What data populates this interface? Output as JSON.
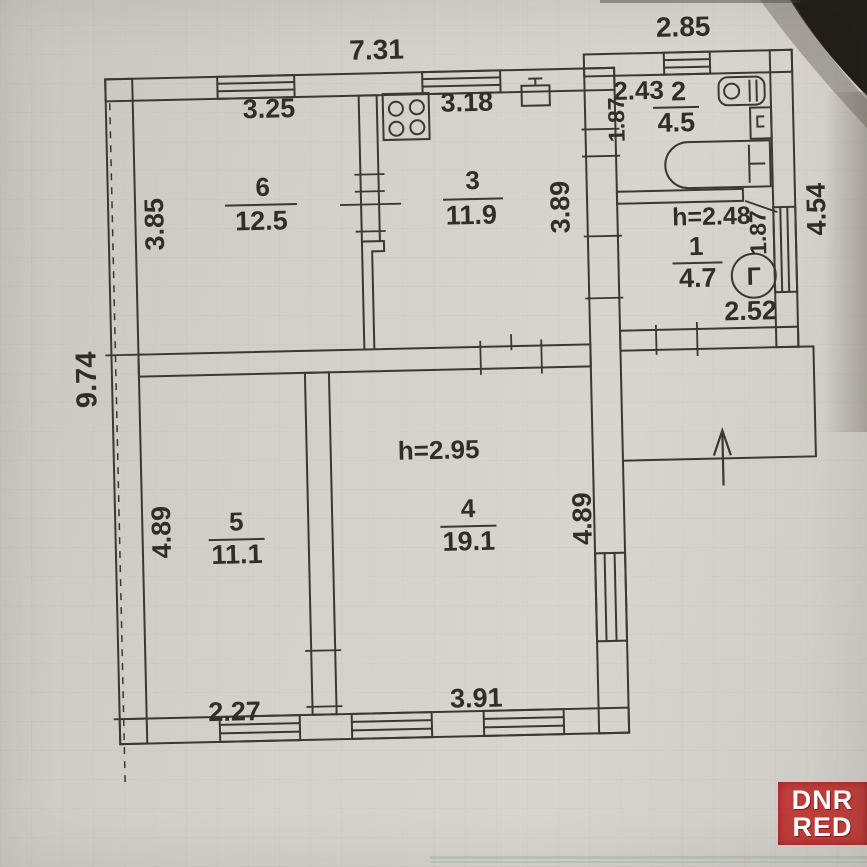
{
  "watermark": {
    "line1": "DNR",
    "line2": "RED",
    "color": "#ba2f2b"
  },
  "rooms": {
    "room1": {
      "number": "1",
      "area": "4.7",
      "ceiling": "h=2.48"
    },
    "room2": {
      "number": "2",
      "area": "4.5"
    },
    "room3": {
      "number": "3",
      "area": "11.9"
    },
    "room4": {
      "number": "4",
      "area": "19.1",
      "ceiling": "h=2.95"
    },
    "room5": {
      "number": "5",
      "area": "11.1"
    },
    "room6": {
      "number": "6",
      "area": "12.5"
    }
  },
  "dimensions": {
    "overall_top": "7.31",
    "annex_top": "2.85",
    "overall_left": "9.74",
    "right_side": "4.54",
    "room6_top": "3.25",
    "room3_top": "3.18",
    "room6_left": "3.85",
    "kitchen_right": "3.89",
    "room2_top": "2.43",
    "room2_left": "1.87",
    "room1_right": "1.87",
    "room1_bottom": "2.52",
    "room5_left": "4.89",
    "room4_right": "4.89",
    "room5_bottom": "2.27",
    "room4_bottom": "3.91"
  },
  "symbols": {
    "gas_meter": "Г"
  },
  "icons": [
    "stove-icon",
    "sink-icon",
    "washbasin-icon",
    "boiler-icon",
    "bathtub-icon",
    "gas-meter-icon",
    "entrance-arrow-icon"
  ],
  "colors": {
    "ink": "#3b3833",
    "paper": "#d3d0ca",
    "watermark_red": "#ba2f2b"
  }
}
